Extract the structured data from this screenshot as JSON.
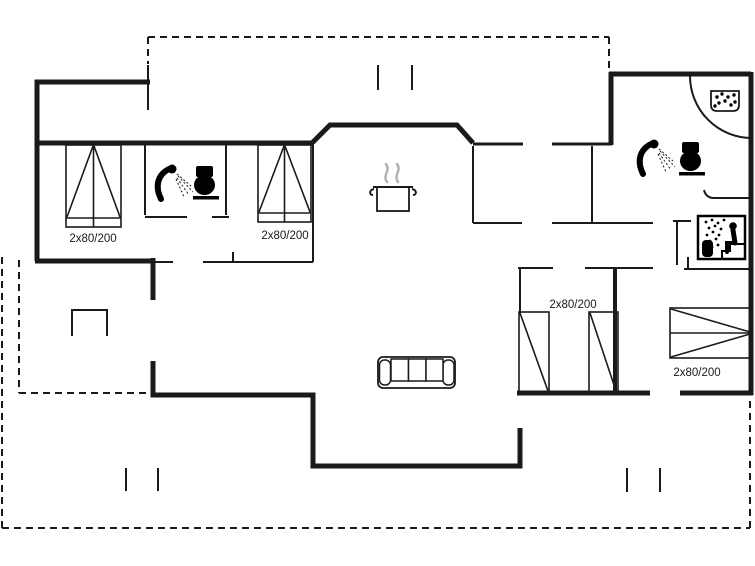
{
  "plan_type": "house floor plan",
  "colors": {
    "background": "#ffffff",
    "wall": "#1a1a1a",
    "icon": "#000000",
    "steam": "#b3b3b3"
  },
  "beds": [
    {
      "room": "bedroom-top-left",
      "label": "2x80/200"
    },
    {
      "room": "bedroom-top-middle",
      "label": "2x80/200"
    },
    {
      "room": "bedroom-bottom-middle",
      "label": "2x80/200"
    },
    {
      "room": "bedroom-bottom-right",
      "label": "2x80/200"
    }
  ],
  "icons": {
    "left_bathroom": [
      "shower-icon",
      "toilet-icon"
    ],
    "right_bathroom": [
      "shower-icon",
      "toilet-icon",
      "washbasin-icon",
      "corner-shower-arc"
    ],
    "sauna_room": [
      "sauna-icon"
    ],
    "kitchen": [
      "cooking-pot-icon"
    ],
    "living_room": [
      "sofa-icon"
    ],
    "terrace": [
      "grill-icon"
    ]
  }
}
